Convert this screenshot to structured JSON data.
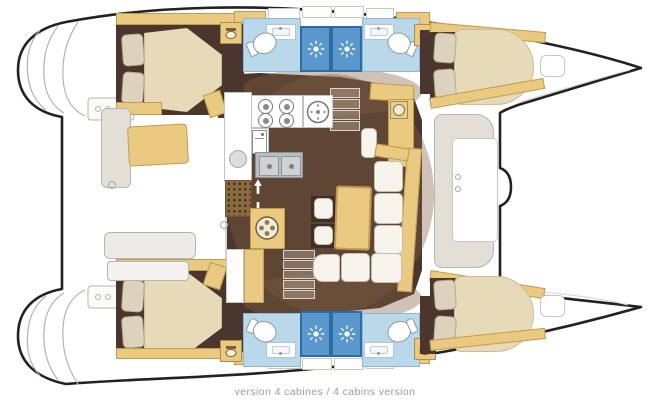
{
  "caption": {
    "text": "version 4 cabines / 4 cabins version"
  },
  "palette": {
    "hull_outline": "#222222",
    "exterior_line": "#b7b5b1",
    "wood_tan": "#e9ca80",
    "wood_edge": "#c19b51",
    "floor_dark_brown": "#4a362c",
    "roof_shadow_brown": "#825e42",
    "bathroom_floor_blue": "#b9d8ea",
    "shower_blue": "#5997cd",
    "shower_border_blue": "#2b6ba6",
    "mattress_cream": "#e7dab9",
    "cushion_white": "#f7f4ee",
    "pillow_beige": "#ddd2bd",
    "caption_gray": "#9b9b9b"
  },
  "icons": {
    "showerhead": "sun-with-rays",
    "toilet": "oval-bowl-with-tank",
    "washbasin": "counter-with-faucet-dot",
    "vanity": "basin-under-tap",
    "stove": "four-round-burners",
    "round_sink": "circle-with-drain-dots",
    "double_sink": "two-square-basins",
    "fridge": "box-with-handle",
    "washing_machine": "round-drum-in-cabinet",
    "chart_instrument": "square-with-dial",
    "companionway": "double-vertical-arrow",
    "floor_grate": "dot-grid"
  },
  "boat": {
    "type": "catamaran-floor-plan",
    "orientation": "bow-right",
    "version_label": "4 cabins",
    "hulls": {
      "port_top": {
        "aft_cabin": {
          "bed": "double",
          "pillows": 2
        },
        "aft_bathroom": {
          "fixtures": [
            "toilet",
            "washbasin",
            "shower"
          ]
        },
        "forward_bathroom": {
          "fixtures": [
            "shower",
            "washbasin",
            "toilet"
          ]
        },
        "forward_cabin": {
          "bed": "double",
          "pillows": 2
        }
      },
      "starboard_bottom": {
        "aft_cabin": {
          "bed": "double",
          "pillows": 2
        },
        "aft_bathroom": {
          "fixtures": [
            "toilet",
            "washbasin",
            "shower"
          ]
        },
        "forward_bathroom": {
          "fixtures": [
            "shower",
            "washbasin",
            "toilet"
          ]
        },
        "forward_cabin": {
          "bed": "double",
          "pillows": 2
        }
      }
    },
    "saloon": {
      "galley": [
        "stove-4-burner",
        "round-sink",
        "double-sink",
        "fridge",
        "worktops"
      ],
      "furniture": [
        "l-shaped-sofa",
        "dining-table",
        "two-stools",
        "chart-table"
      ],
      "stairs": [
        "port-companionway",
        "starboard-companionway"
      ]
    },
    "exterior": {
      "aft": [
        "port-swim-platform",
        "starboard-swim-platform",
        "cockpit-benches",
        "cockpit-cushion"
      ],
      "forward": [
        "forward-cockpit-seat",
        "deck-hatches",
        "bows"
      ]
    }
  }
}
